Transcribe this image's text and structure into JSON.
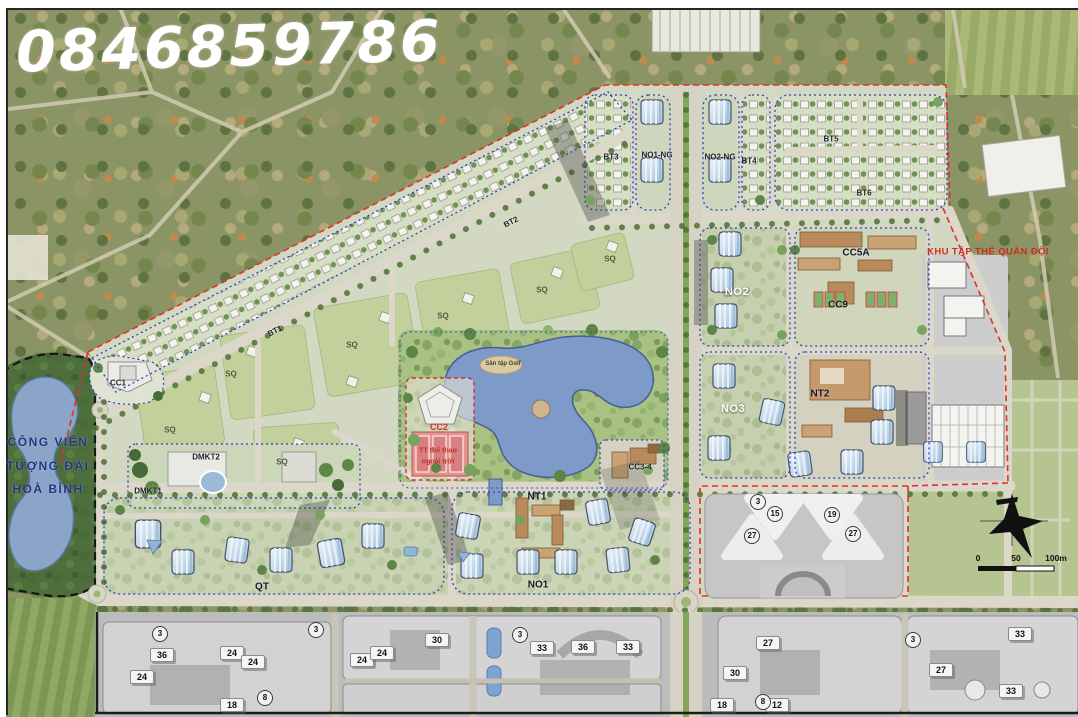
{
  "watermark": "0846859786",
  "park": {
    "line1": "CÔNG VIÊN",
    "line2": "TƯỢNG ĐÀI",
    "line3": "HOÀ BÌNH"
  },
  "military_area_label": "KHU TẬP THỂ QUÂN ĐỘI",
  "lake_stage_label": "Sân tập Golf",
  "cc2_block": {
    "zone": "CC2",
    "line1": "TT thể thao",
    "line2": "ngoài trời"
  },
  "scale_bar": {
    "zero": "0",
    "fifty": "50",
    "hundred": "100m"
  },
  "zone_labels": [
    {
      "text": "BT1",
      "x": 275,
      "y": 331,
      "cls": "zone-xs",
      "rot": -27
    },
    {
      "text": "BT2",
      "x": 511,
      "y": 222,
      "cls": "zone-xs",
      "rot": -27
    },
    {
      "text": "BT3",
      "x": 611,
      "y": 157,
      "cls": "zone-xs"
    },
    {
      "text": "NO1-NG",
      "x": 657,
      "y": 155,
      "cls": "zone-xs"
    },
    {
      "text": "NO2-NG",
      "x": 720,
      "y": 157,
      "cls": "zone-xs"
    },
    {
      "text": "BT4",
      "x": 749,
      "y": 161,
      "cls": "zone-xs"
    },
    {
      "text": "BT5",
      "x": 831,
      "y": 139,
      "cls": "zone-xs"
    },
    {
      "text": "BT6",
      "x": 864,
      "y": 193,
      "cls": "zone-xs"
    },
    {
      "text": "CC1",
      "x": 118,
      "y": 383,
      "cls": "zone-xs"
    },
    {
      "text": "CC5A",
      "x": 856,
      "y": 253,
      "cls": "zone-s"
    },
    {
      "text": "CC9",
      "x": 838,
      "y": 305,
      "cls": "zone-s"
    },
    {
      "text": "NO2",
      "x": 737,
      "y": 292,
      "cls": "zone-w"
    },
    {
      "text": "NO3",
      "x": 733,
      "y": 409,
      "cls": "zone-w"
    },
    {
      "text": "NT2",
      "x": 820,
      "y": 394,
      "cls": "zone-s"
    },
    {
      "text": "NT1",
      "x": 537,
      "y": 497,
      "cls": "zone-s"
    },
    {
      "text": "NO1",
      "x": 538,
      "y": 585,
      "cls": "zone-s"
    },
    {
      "text": "QT",
      "x": 262,
      "y": 587,
      "cls": "zone-s"
    },
    {
      "text": "CC3-4",
      "x": 640,
      "y": 467,
      "cls": "zone-xs"
    },
    {
      "text": "DMKT1",
      "x": 148,
      "y": 491,
      "cls": "zone-xs"
    },
    {
      "text": "DMKT2",
      "x": 206,
      "y": 457,
      "cls": "zone-xs"
    },
    {
      "text": "SQ",
      "x": 170,
      "y": 430,
      "cls": "sq"
    },
    {
      "text": "SQ",
      "x": 282,
      "y": 462,
      "cls": "sq"
    },
    {
      "text": "SQ",
      "x": 231,
      "y": 374,
      "cls": "sq"
    },
    {
      "text": "SQ",
      "x": 352,
      "y": 345,
      "cls": "sq"
    },
    {
      "text": "SQ",
      "x": 443,
      "y": 316,
      "cls": "sq"
    },
    {
      "text": "SQ",
      "x": 542,
      "y": 290,
      "cls": "sq"
    },
    {
      "text": "SQ",
      "x": 610,
      "y": 259,
      "cls": "sq"
    }
  ],
  "building_numbers": [
    {
      "text": "36",
      "x": 162,
      "y": 655
    },
    {
      "text": "24",
      "x": 142,
      "y": 677
    },
    {
      "text": "24",
      "x": 232,
      "y": 653
    },
    {
      "text": "24",
      "x": 253,
      "y": 662
    },
    {
      "text": "24",
      "x": 362,
      "y": 660
    },
    {
      "text": "24",
      "x": 382,
      "y": 653
    },
    {
      "text": "30",
      "x": 437,
      "y": 640
    },
    {
      "text": "18",
      "x": 232,
      "y": 705
    },
    {
      "text": "33",
      "x": 542,
      "y": 648
    },
    {
      "text": "36",
      "x": 583,
      "y": 647
    },
    {
      "text": "33",
      "x": 628,
      "y": 647
    },
    {
      "text": "27",
      "x": 768,
      "y": 643
    },
    {
      "text": "30",
      "x": 735,
      "y": 673
    },
    {
      "text": "18",
      "x": 722,
      "y": 705
    },
    {
      "text": "12",
      "x": 777,
      "y": 705
    },
    {
      "text": "33",
      "x": 1020,
      "y": 634
    },
    {
      "text": "27",
      "x": 941,
      "y": 670
    },
    {
      "text": "33",
      "x": 1011,
      "y": 691
    }
  ],
  "circled_numbers": [
    {
      "text": "15",
      "x": 775,
      "y": 514
    },
    {
      "text": "19",
      "x": 832,
      "y": 515
    },
    {
      "text": "27",
      "x": 752,
      "y": 536
    },
    {
      "text": "27",
      "x": 853,
      "y": 534
    },
    {
      "text": "3",
      "x": 758,
      "y": 502
    },
    {
      "text": "3",
      "x": 316,
      "y": 630
    },
    {
      "text": "3",
      "x": 520,
      "y": 635
    },
    {
      "text": "3",
      "x": 913,
      "y": 640
    },
    {
      "text": "3",
      "x": 160,
      "y": 634
    },
    {
      "text": "8",
      "x": 265,
      "y": 698
    },
    {
      "text": "8",
      "x": 763,
      "y": 702
    }
  ]
}
